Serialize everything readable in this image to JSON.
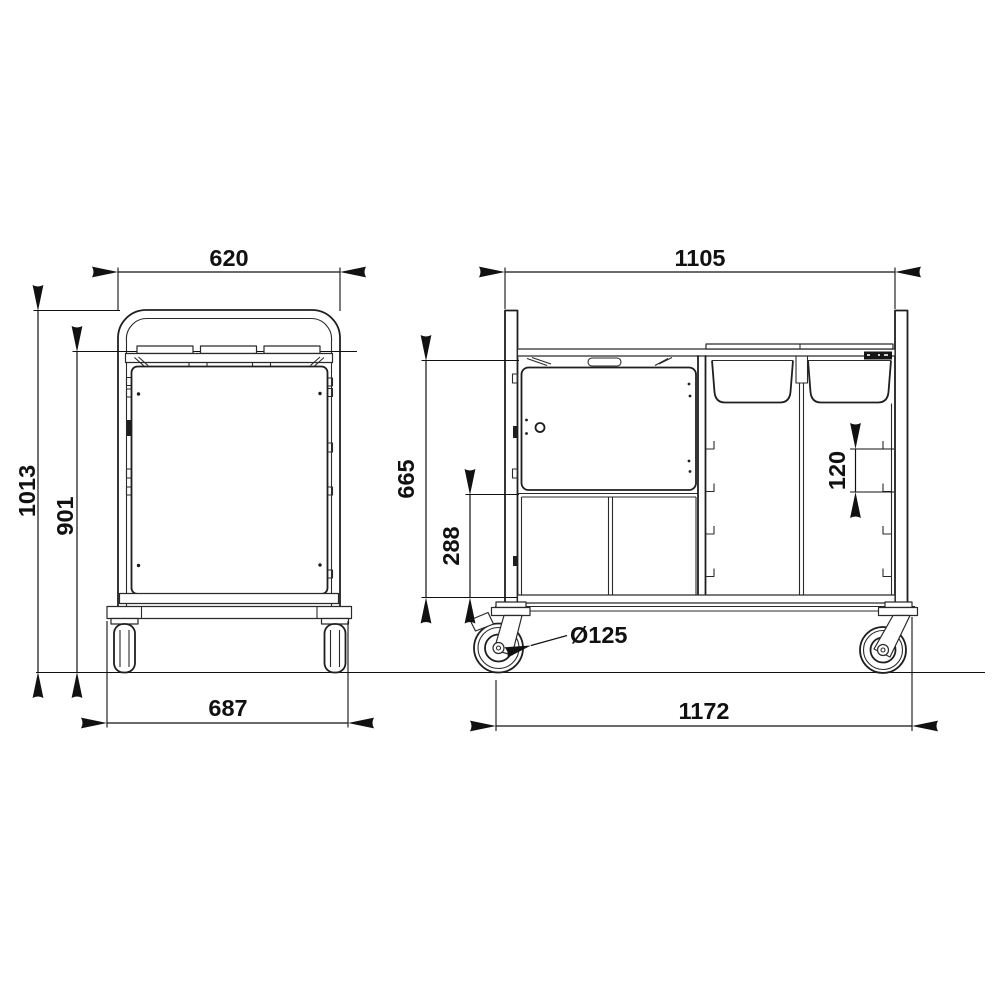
{
  "dimensions": {
    "front": {
      "top_width": "620",
      "overall_height": "1013",
      "inner_height": "901",
      "base_width": "687"
    },
    "side": {
      "top_width": "1105",
      "upper_height": "665",
      "lower_compartment_height": "288",
      "drawer_pitch": "120",
      "caster_diameter": "Ø125",
      "base_width": "1172"
    }
  }
}
